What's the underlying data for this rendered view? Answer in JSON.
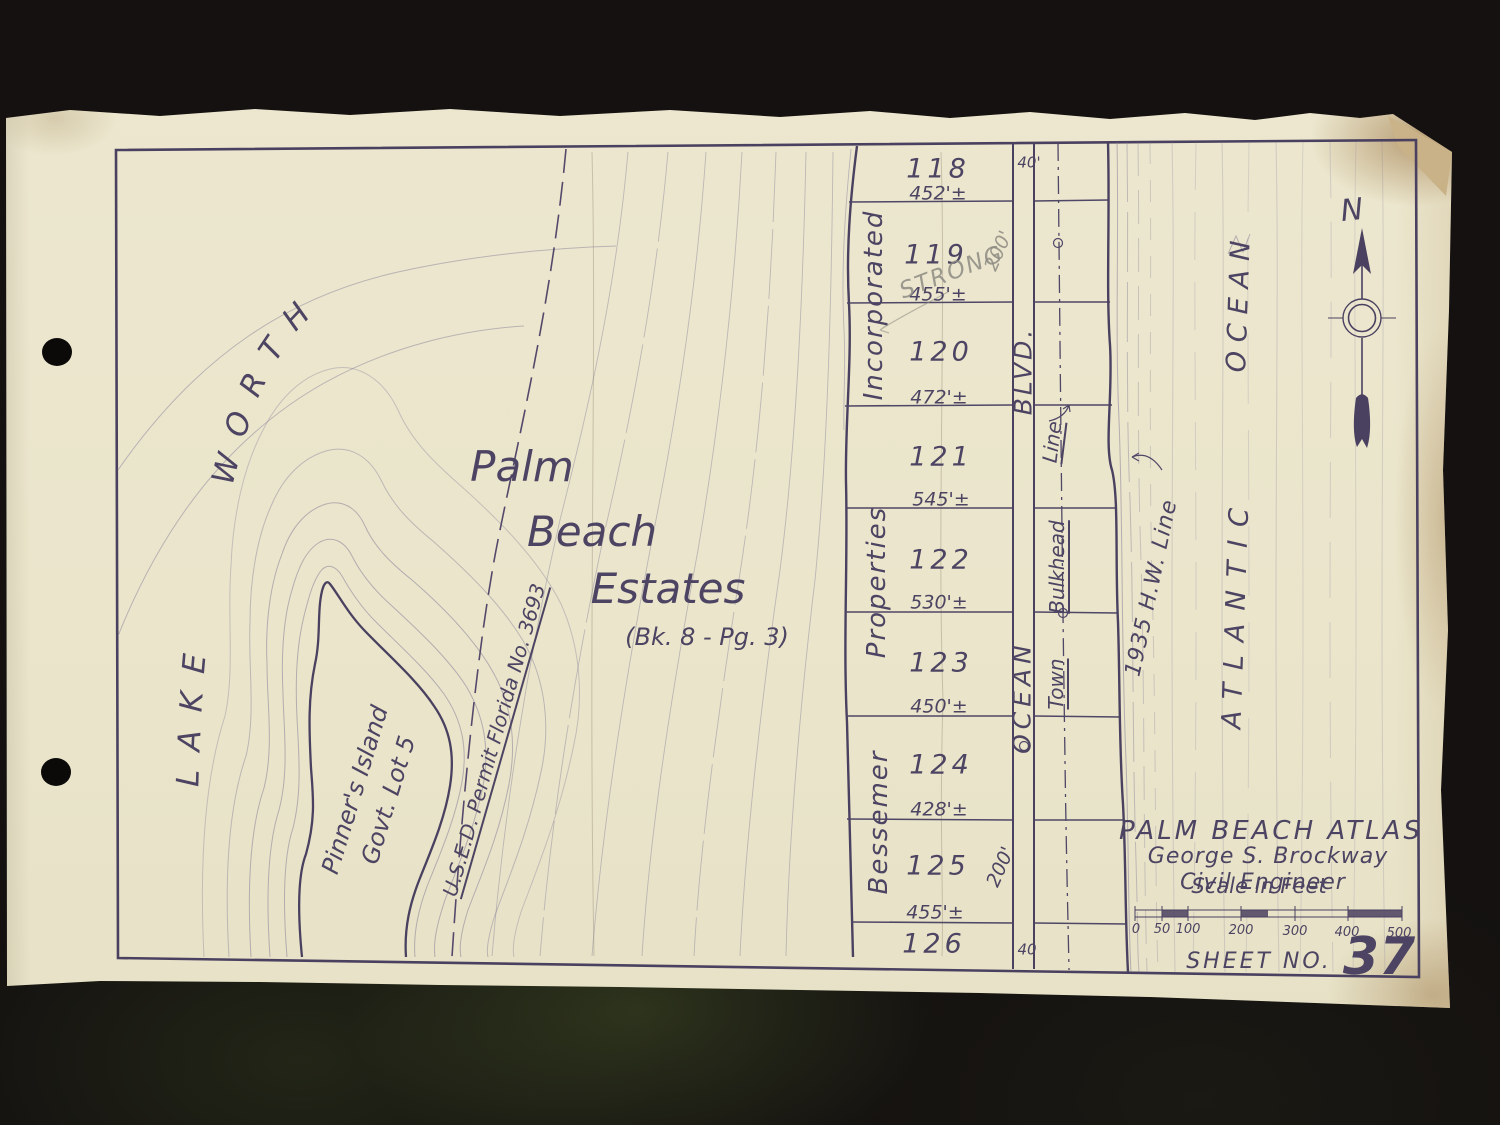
{
  "colors": {
    "paper": "#ebe6cd",
    "ink": "#4c4462",
    "ink_light": "#7d7694",
    "pencil": "#8e8b84",
    "table": "#141110",
    "stain": "#a9834f"
  },
  "map": {
    "lake_label": "LAKE WORTH",
    "island_label": [
      "Pinner's Island",
      "Govt. Lot 5"
    ],
    "permit_label": "U.S.E.D. Permit Florida No. 3693",
    "subdivision": {
      "line1": "Palm",
      "line2": "Beach",
      "line3": "Estates",
      "plat_ref": "(Bk. 8 - Pg. 3)"
    },
    "owner_labels": [
      "Incorporated",
      "Properties",
      "Bessemer"
    ],
    "lots": [
      {
        "number": "118",
        "frontage": "452'±"
      },
      {
        "number": "119",
        "frontage": "455'±"
      },
      {
        "number": "120",
        "frontage": "472'±"
      },
      {
        "number": "121",
        "frontage": "545'±"
      },
      {
        "number": "122",
        "frontage": "530'±"
      },
      {
        "number": "123",
        "frontage": "450'±"
      },
      {
        "number": "124",
        "frontage": "428'±"
      },
      {
        "number": "125",
        "frontage": "455'±"
      },
      {
        "number": "126",
        "frontage": null
      }
    ],
    "lot_depth": "200'",
    "street": {
      "width_top": "40'",
      "width_bottom": "40",
      "name_word1": "OCEAN",
      "name_word2": "BLVD."
    },
    "bulkhead": {
      "word1": "Town",
      "word2": "Bulkhead",
      "word3": "Line"
    },
    "high_water_label": "1935 H.W. Line",
    "ocean": {
      "word1": "ATLANTIC",
      "word2": "OCEAN"
    },
    "north": "N",
    "pencil": {
      "note": "STRONG",
      "dim": "200'"
    }
  },
  "title_block": {
    "title": "PALM BEACH ATLAS",
    "author": "George S. Brockway",
    "profession": "Civil Engineer",
    "scale_caption": "Scale in Feet",
    "scale_ticks": [
      "0",
      "50",
      "100",
      "200",
      "300",
      "400",
      "500"
    ],
    "sheet_label": "SHEET NO.",
    "sheet_number": "37"
  }
}
